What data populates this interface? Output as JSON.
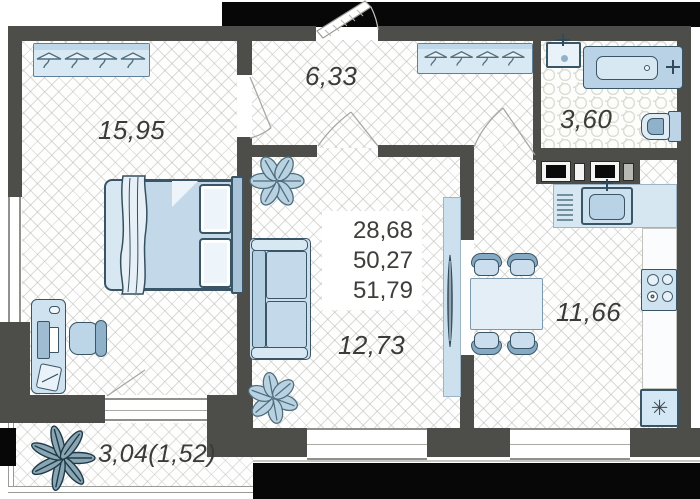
{
  "floor_plan": {
    "labels": {
      "bedroom": "15,95",
      "hallway": "6,33",
      "bathroom": "3,60",
      "living_room": "12,73",
      "kitchen": "11,66",
      "balcony": "3,04(1,52)"
    },
    "area_summary": {
      "line1": "28,68",
      "line2": "50,27",
      "line3": "51,79"
    },
    "icons": {
      "fridge_glyph": "✳"
    },
    "colors": {
      "wall": "#4d4d49",
      "outside": "#070707",
      "furniture_fill": "#d5e5f1",
      "furniture_stroke": "#3a5565",
      "floor_line": "#d9d9d4"
    }
  }
}
